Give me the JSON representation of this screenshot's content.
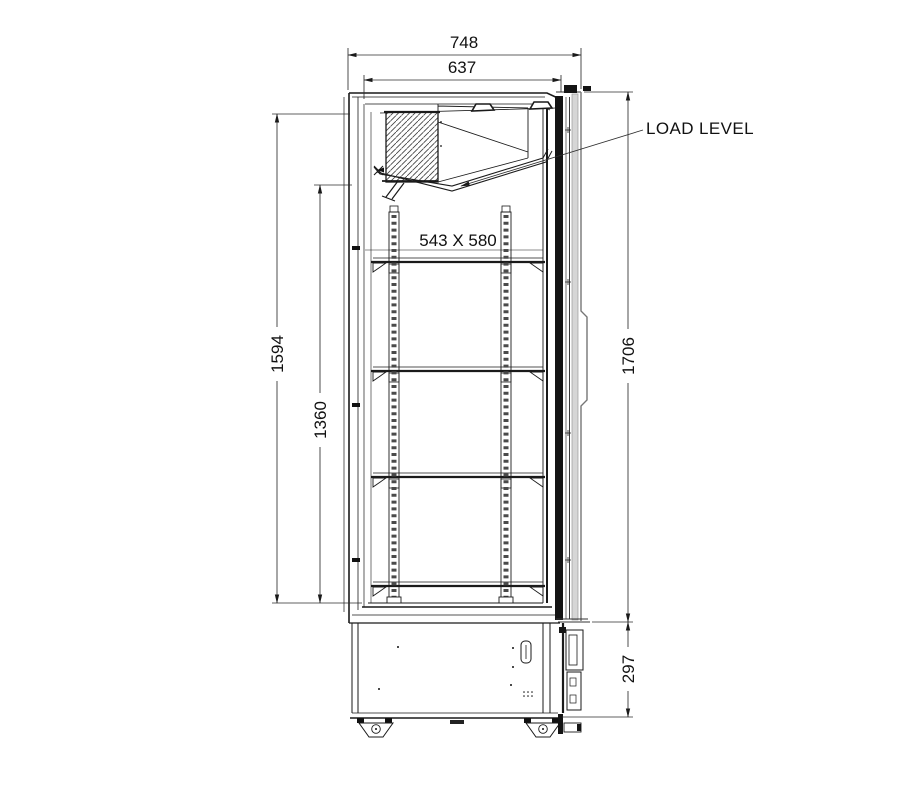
{
  "canvas": {
    "width": 922,
    "height": 804,
    "background": "#ffffff"
  },
  "drawing": {
    "type": "refrigerated-cabinet-side-elevation",
    "labels": {
      "load_level": "LOAD LEVEL",
      "shelf_size": "543 X 580"
    },
    "dimensions": {
      "overall_depth": "748",
      "body_depth": "637",
      "interior_height": "1594",
      "clear_height": "1360",
      "overall_height": "1706",
      "base_height": "297"
    },
    "colors": {
      "line": "#1a1a1a",
      "dim": "#2e2e2e",
      "text": "#111111",
      "door_gray": "#d6d6d6",
      "background": "#ffffff"
    }
  }
}
